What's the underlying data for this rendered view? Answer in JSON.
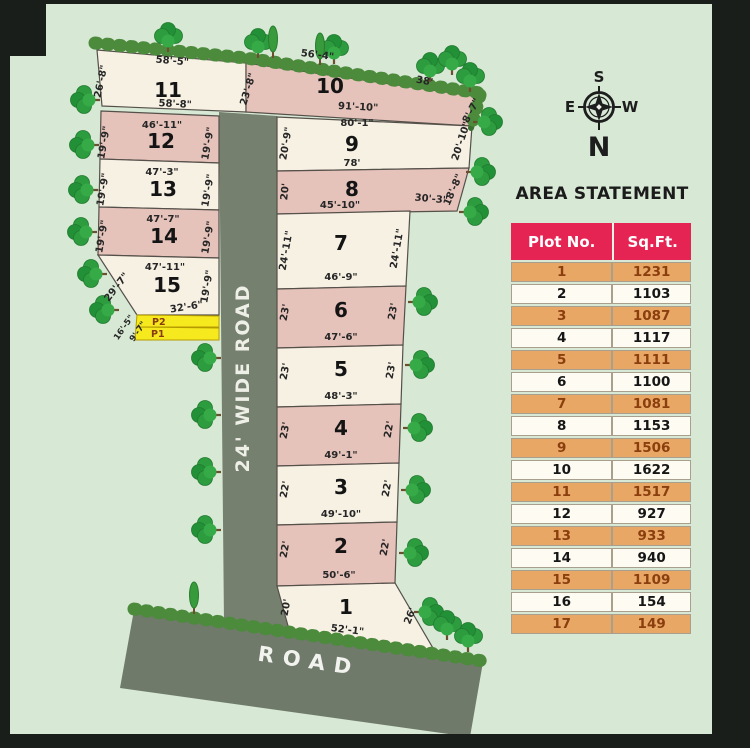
{
  "site": {
    "roads": {
      "vertical": "24' WIDE ROAD",
      "bottom": "ROAD"
    },
    "compass": {
      "top": "S",
      "bottom": "N",
      "left": "E",
      "right": "W"
    },
    "parking": {
      "p2_label": "P2",
      "p1_label": "P1"
    },
    "plots": {
      "p1": {
        "no": "1",
        "left": "20'",
        "right": "26'",
        "bottom": "52'-1\""
      },
      "p2": {
        "no": "2",
        "left": "22'",
        "right": "22'",
        "bottom": "50'-6\""
      },
      "p3": {
        "no": "3",
        "left": "22'",
        "right": "22'",
        "bottom": "49'-10\""
      },
      "p4": {
        "no": "4",
        "left": "23'",
        "right": "22'",
        "bottom": "49'-1\""
      },
      "p5": {
        "no": "5",
        "left": "23'",
        "right": "23'",
        "bottom": "48'-3\""
      },
      "p6": {
        "no": "6",
        "left": "23'",
        "right": "23'",
        "bottom": "47'-6\""
      },
      "p7": {
        "no": "7",
        "left": "24'-11\"",
        "right": "24'-11\"",
        "bottom": "46'-9\""
      },
      "p8": {
        "no": "8",
        "left": "20'",
        "right": "18'-8\"",
        "bottom_left": "45'-10\"",
        "bottom_right": "30'-3\""
      },
      "p9": {
        "no": "9",
        "top": "80'-1\"",
        "bottom": "78'",
        "left": "20'-9\"",
        "right": "20'-10\""
      },
      "p10": {
        "no": "10",
        "top_left": "56'-4\"",
        "top_right": "38'",
        "bottom": "91'-10\"",
        "right": "8'-7\""
      },
      "p11": {
        "no": "11",
        "top": "58'-5\"",
        "bottom": "58'-8\"",
        "left": "26'-8\"",
        "right": "23'-8\""
      },
      "p12": {
        "no": "12",
        "top": "46'-11\"",
        "left": "19'-9\"",
        "right": "19'-9\""
      },
      "p13": {
        "no": "13",
        "top": "47'-3\"",
        "left": "19'-9\"",
        "right": "19'-9\""
      },
      "p14": {
        "no": "14",
        "top": "47'-7\"",
        "left": "19'-9\"",
        "right": "19'-9\""
      },
      "p15": {
        "no": "15",
        "top": "47'-11\"",
        "left": "29'-7\"",
        "right": "19'-9\"",
        "strip_width": "32'-6\"",
        "strip_left_a": "16'-5\"",
        "strip_left_b": "9'-7\""
      }
    }
  },
  "area_statement": {
    "title": "AREA STATEMENT",
    "columns": [
      "Plot No.",
      "Sq.Ft."
    ],
    "rows": [
      {
        "plot": "1",
        "sqft": "1231"
      },
      {
        "plot": "2",
        "sqft": "1103"
      },
      {
        "plot": "3",
        "sqft": "1087"
      },
      {
        "plot": "4",
        "sqft": "1117"
      },
      {
        "plot": "5",
        "sqft": "1111"
      },
      {
        "plot": "6",
        "sqft": "1100"
      },
      {
        "plot": "7",
        "sqft": "1081"
      },
      {
        "plot": "8",
        "sqft": "1153"
      },
      {
        "plot": "9",
        "sqft": "1506"
      },
      {
        "plot": "10",
        "sqft": "1622"
      },
      {
        "plot": "11",
        "sqft": "1517"
      },
      {
        "plot": "12",
        "sqft": "927"
      },
      {
        "plot": "13",
        "sqft": "933"
      },
      {
        "plot": "14",
        "sqft": "940"
      },
      {
        "plot": "15",
        "sqft": "1109"
      },
      {
        "plot": "16",
        "sqft": "154"
      },
      {
        "plot": "17",
        "sqft": "149"
      }
    ]
  },
  "colors": {
    "background": "#d7e8d5",
    "plot_cream": "#f7f1e4",
    "plot_pink": "#e5c2ba",
    "road_gray": "#75806f",
    "parking_yellow": "#f6ea1f",
    "table_header": "#e62454",
    "table_orange": "#e9a765",
    "hedge_green": "#4c8a3c"
  }
}
